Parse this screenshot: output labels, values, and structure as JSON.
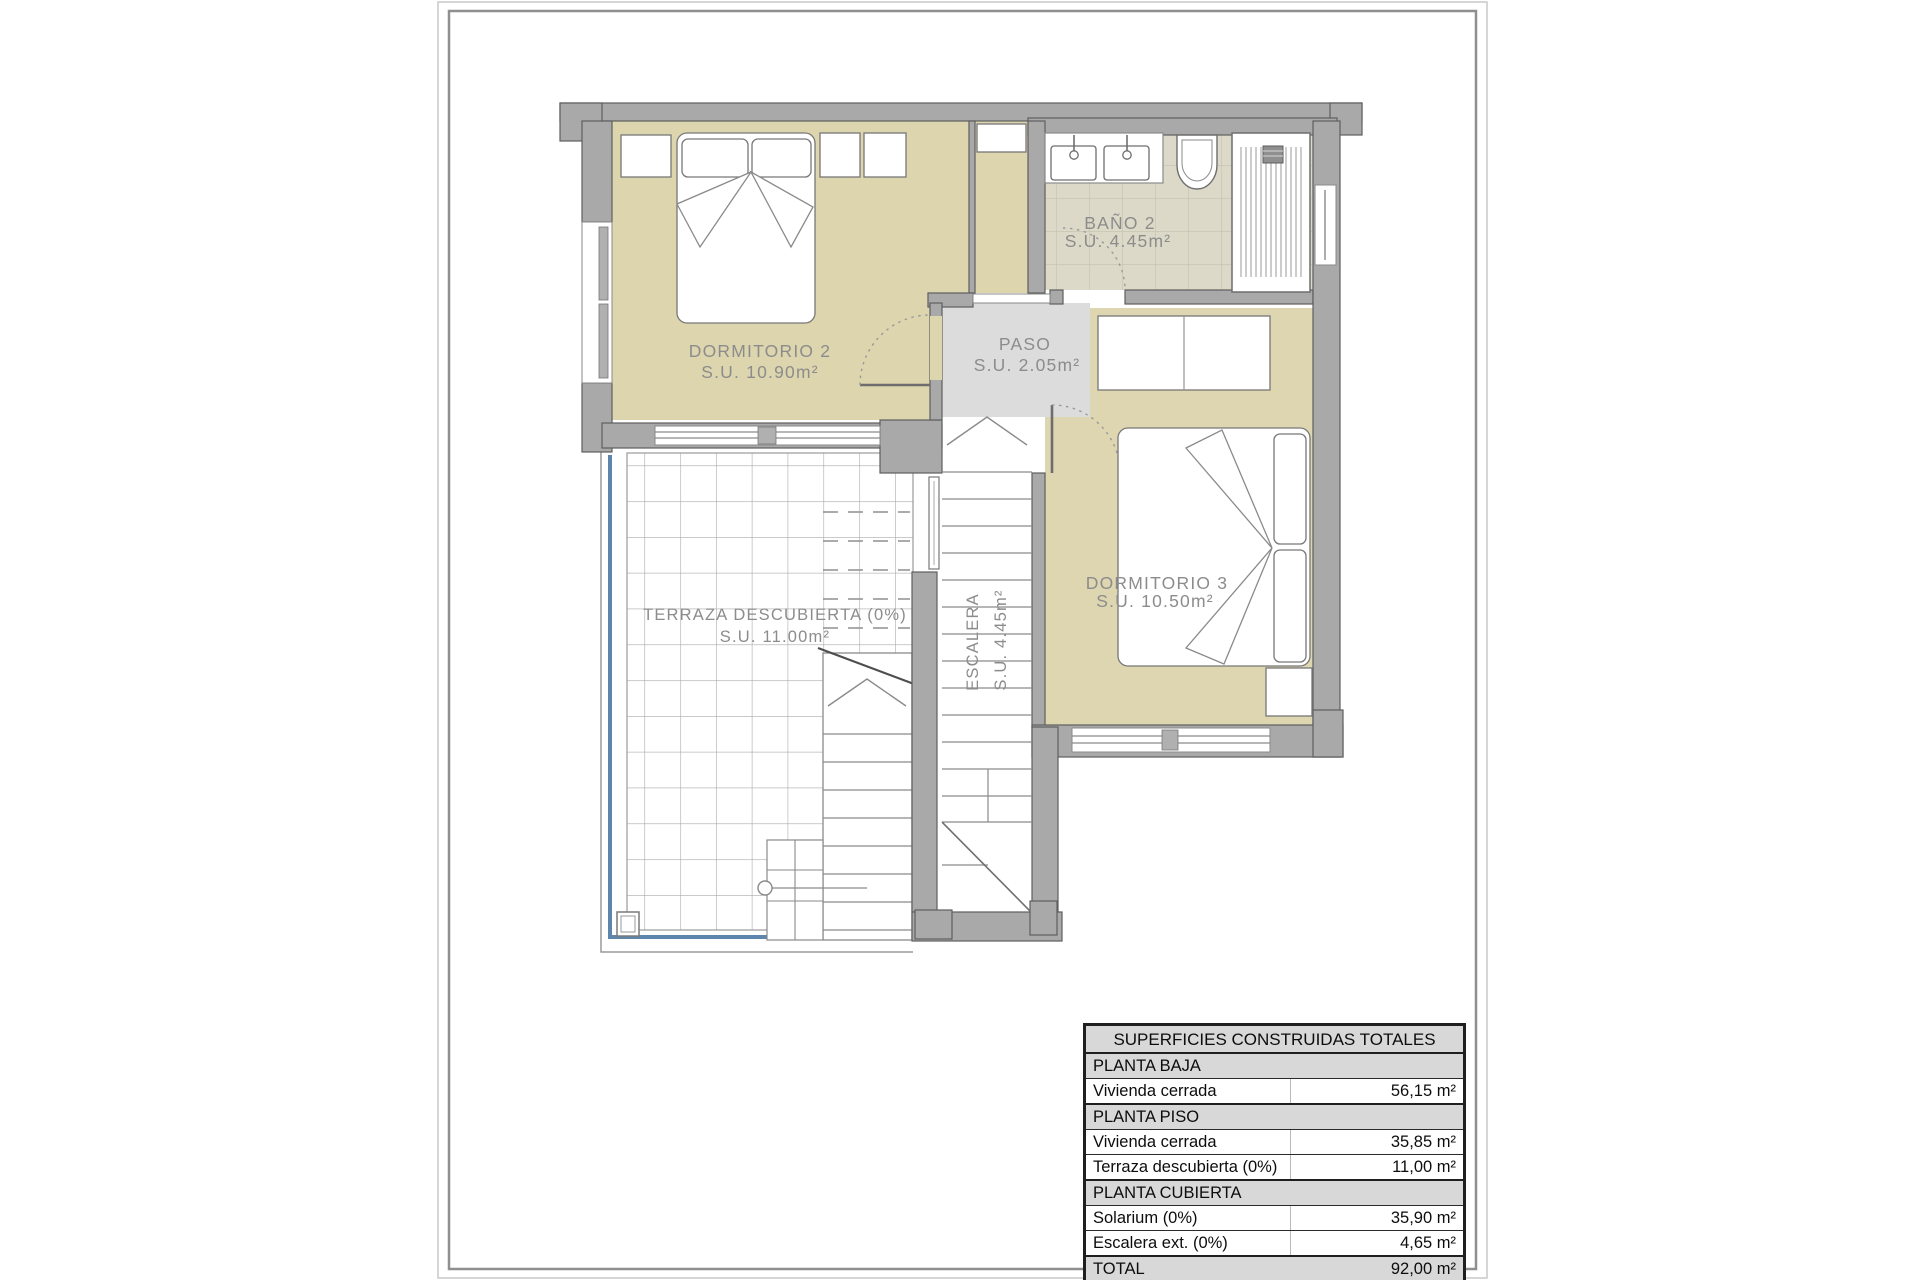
{
  "plan": {
    "rooms": {
      "dormitorio2": {
        "name": "DORMITORIO 2",
        "area": "S.U. 10.90m²"
      },
      "bano2": {
        "name": "BAÑO 2",
        "area": "S.U. 4.45m²"
      },
      "paso": {
        "name": "PASO",
        "area": "S.U. 2.05m²"
      },
      "dormitorio3": {
        "name": "DORMITORIO 3",
        "area": "S.U. 10.50m²"
      },
      "terraza": {
        "name": "TERRAZA DESCUBIERTA (0%)",
        "area": "S.U. 11.00m²"
      },
      "escalera": {
        "name": "ESCALERA",
        "area": "S.U. 4.45m²"
      }
    },
    "colors": {
      "room_fill": "#DDD5AE",
      "wall_fill": "#A9A9A9",
      "paso_fill": "#DCDCDC",
      "bath_tile": "#DDD9C8",
      "terrace_edge_blue": "#5E86AC",
      "label_gray": "#8C8C8C"
    }
  },
  "table": {
    "title": "SUPERFICIES CONSTRUIDAS TOTALES",
    "rows": [
      {
        "type": "section",
        "label": "PLANTA BAJA",
        "value": ""
      },
      {
        "type": "data",
        "label": "Vivienda cerrada",
        "value": "56,15 m²"
      },
      {
        "type": "section",
        "label": "PLANTA PISO",
        "value": ""
      },
      {
        "type": "data",
        "label": "Vivienda cerrada",
        "value": "35,85 m²"
      },
      {
        "type": "data",
        "label": "Terraza descubierta (0%)",
        "value": "11,00 m²"
      },
      {
        "type": "section",
        "label": "PLANTA CUBIERTA",
        "value": ""
      },
      {
        "type": "data",
        "label": "Solarium (0%)",
        "value": "35,90 m²"
      },
      {
        "type": "data",
        "label": "Escalera ext. (0%)",
        "value": "4,65 m²"
      },
      {
        "type": "total",
        "label": "TOTAL",
        "value": "92,00 m²"
      }
    ]
  }
}
